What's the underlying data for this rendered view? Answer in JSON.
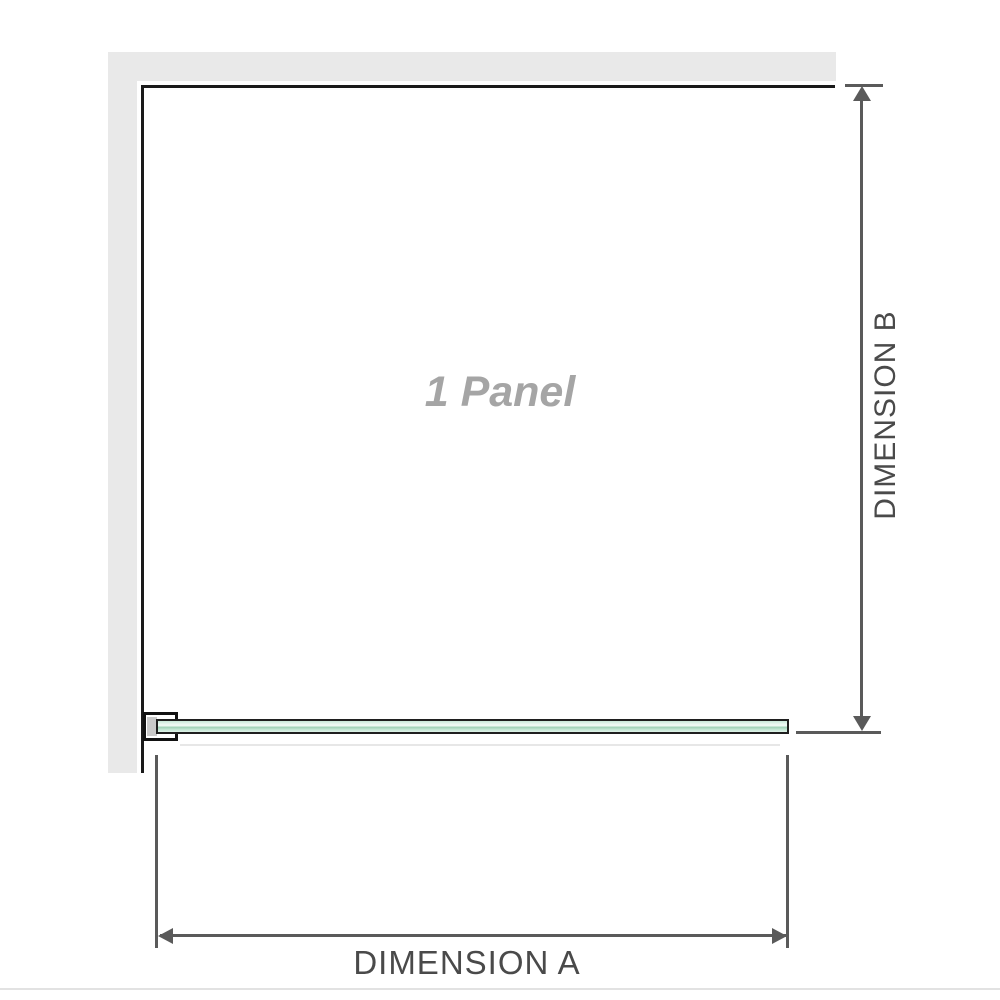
{
  "diagram": {
    "panel_label": "1 Panel",
    "dimension_a": {
      "label": "DIMENSION A"
    },
    "dimension_b": {
      "label": "DIMENSION B"
    }
  },
  "colors": {
    "wall_fill": "#e9e9e9",
    "wall_edge_line": "#1a1a1a",
    "dimension_line": "#5a5a5a",
    "dimension_text": "#4a4a4a",
    "panel_label_text": "#a5a5a5",
    "glass_border": "#1f1f1f",
    "glass_green_light": "#dff2e8",
    "glass_green_mid": "#9ed1b6",
    "bracket_border": "#111111",
    "bracket_pad_fill": "#c9c9c9",
    "footer_line": "#e2e2e2"
  }
}
